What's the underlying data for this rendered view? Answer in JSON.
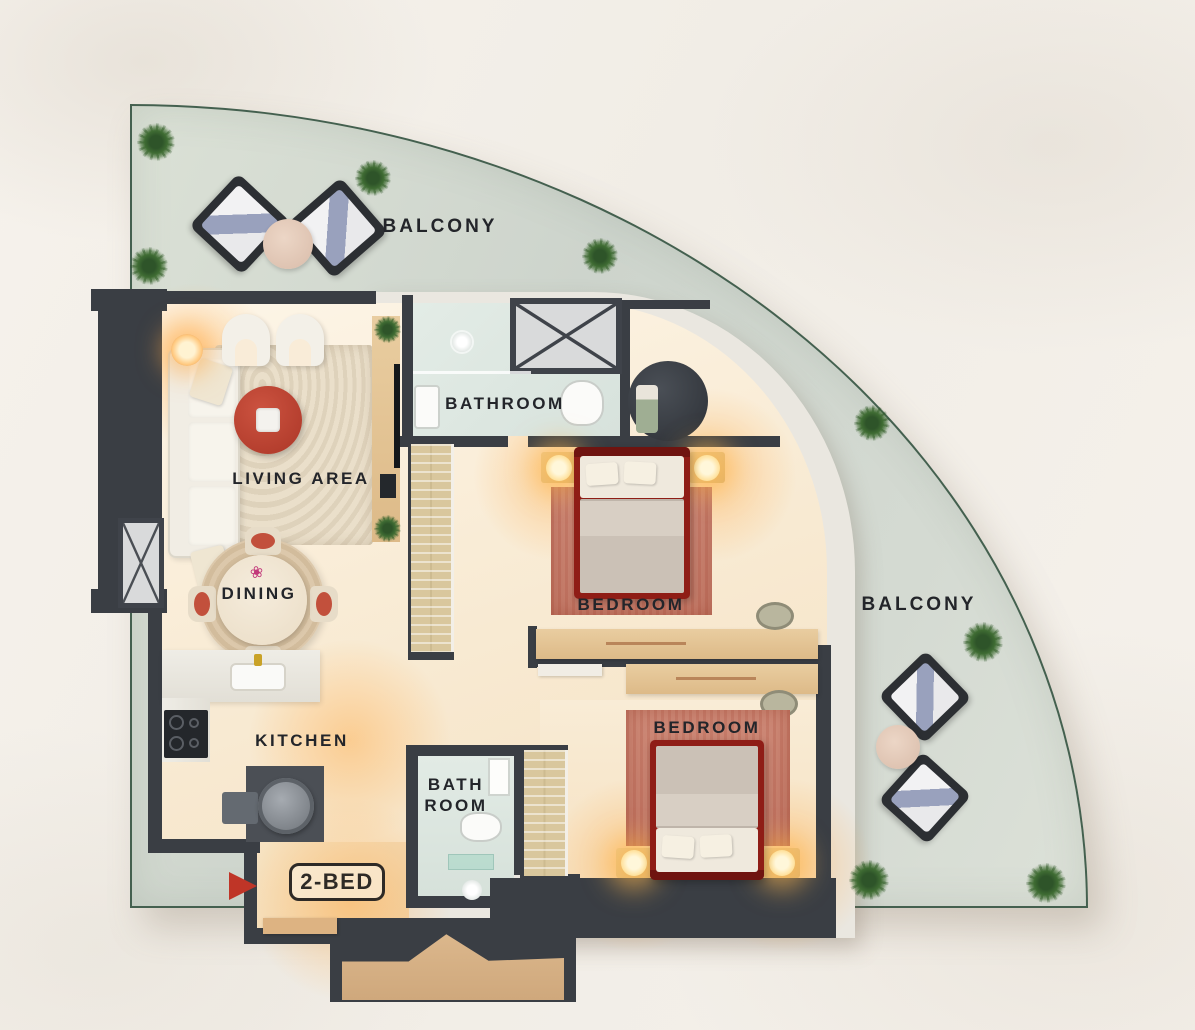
{
  "plan": {
    "unit_badge": "2-BED",
    "labels": {
      "balcony_top": "BALCONY",
      "balcony_right": "BALCONY",
      "bathroom_main": "BATHROOM",
      "living": "LIVING AREA",
      "dining": "DINING",
      "kitchen": "KITCHEN",
      "bedroom_1": "BEDROOM",
      "bedroom_2": "BEDROOM",
      "bath_2_line1": "BATH",
      "bath_2_line2": "ROOM"
    },
    "colors": {
      "wall": "#3a3e44",
      "balcony_floor": "#d3d9d0",
      "balcony_edge": "#44604f",
      "interior_floor": "#f8ead4",
      "bath_floor": "#dde7e1",
      "accent_red": "#bf3527",
      "bed_frame": "#8f1d16",
      "rug": "#c87f6e",
      "wood": "#d9ba8c",
      "label_text": "#23252a"
    }
  }
}
